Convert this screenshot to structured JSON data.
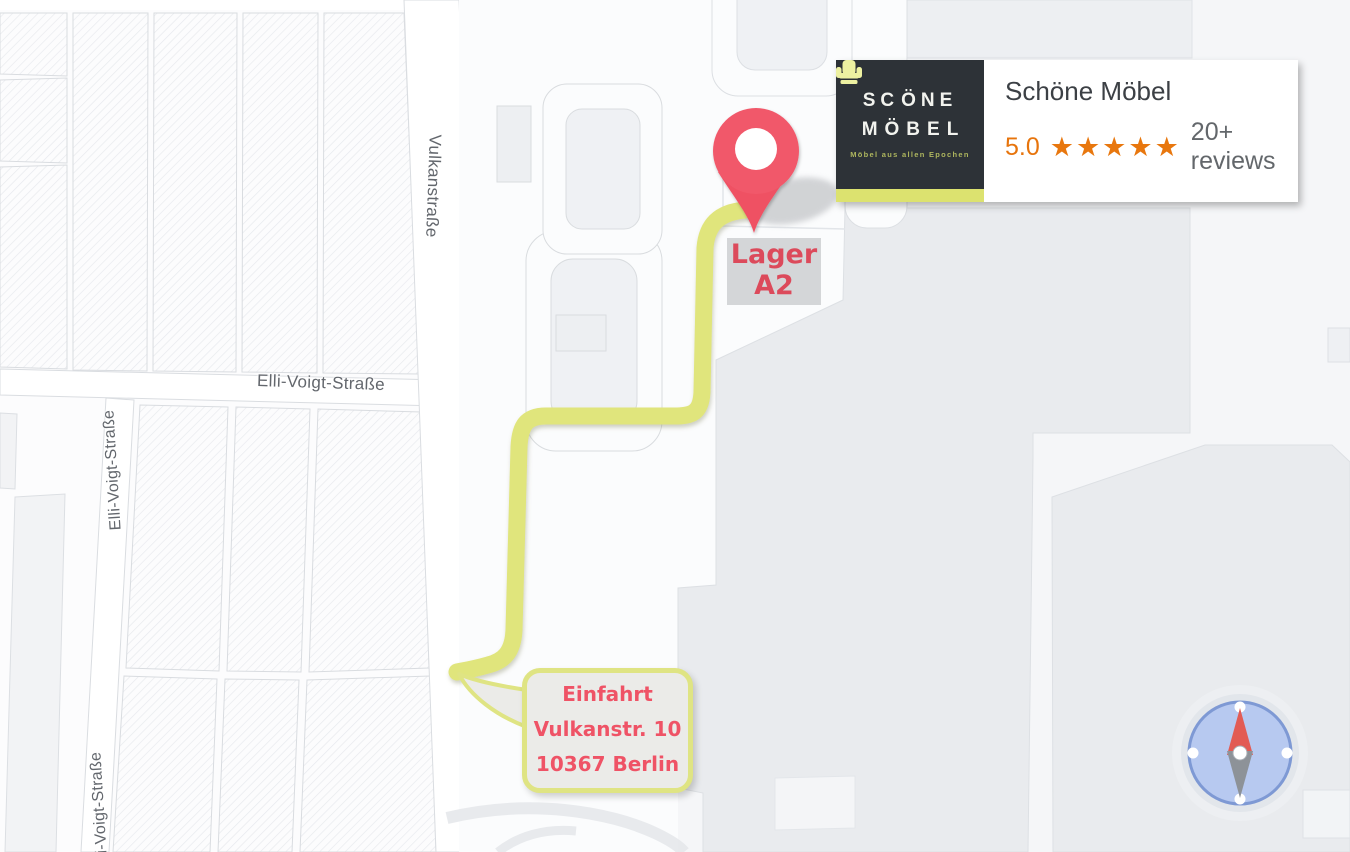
{
  "map": {
    "street_labels": {
      "vulkanstrasse": "Vulkanstraße",
      "elli_voigt_horizontal": "Elli-Voigt-Straße",
      "elli_voigt_vertical_upper": "Elli-Voigt-Straße",
      "elli_voigt_vertical_lower": "Elli-Voigt-Straße"
    },
    "marker": {
      "label_line1": "Lager",
      "label_line2": "A2"
    },
    "entrance_callout": {
      "line1": "Einfahrt",
      "line2": "Vulkanstr. 10",
      "line3": "10367 Berlin"
    },
    "icons": {
      "pin": "map-pin-icon",
      "compass": "compass-icon",
      "chair": "armchair-icon"
    },
    "colors": {
      "route_yellow": "#e0e57c",
      "pin_red": "#f1586a",
      "annotation_red": "#df4e5f",
      "compass_blue": "#b7c9f0"
    }
  },
  "business_card": {
    "logo": {
      "word_part1": "SC",
      "word_part2": "ÖNE",
      "word_line2": "MÖBEL",
      "tagline": "Möbel aus allen Epochen",
      "bg_color": "#2d3237",
      "accent_color": "#dce26f"
    },
    "title": "Schöne Möbel",
    "rating": {
      "value": "5.0",
      "stars": "★★★★★",
      "reviews_text": "20+ reviews",
      "color": "#e8770e"
    }
  }
}
